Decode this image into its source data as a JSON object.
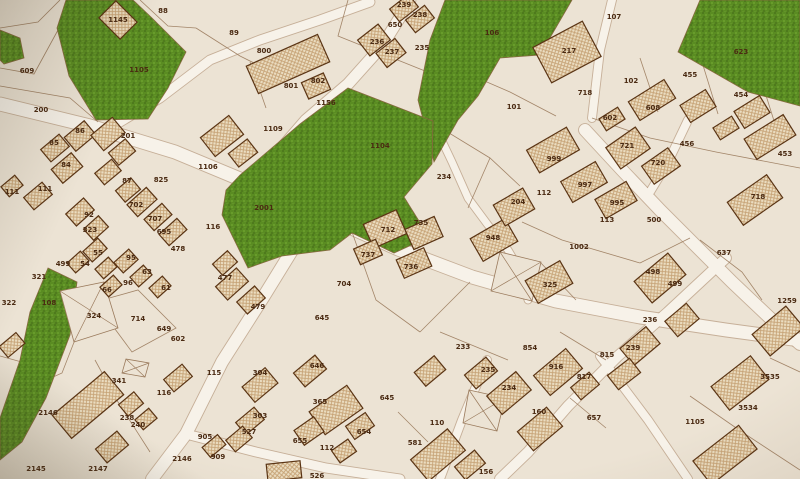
{
  "map": {
    "canvas": {
      "width": 800,
      "height": 479
    },
    "palette": {
      "base": "#ece3d4",
      "road": "#f7f2e9",
      "road_edge": "#b29478",
      "line": "#9a7a5c",
      "green_fill": "#5a8c22",
      "green_edge": "#87693f",
      "building_edge": "#5a3414",
      "label_color": "#4a2a12"
    },
    "green_areas": [
      {
        "name": "park-1105",
        "points": "66,0 133,0 152,18 186,52 168,88 148,119 96,120 69,76 57,28"
      },
      {
        "name": "park-west-sliver",
        "points": "0,30 20,38 24,58 4,64 0,60"
      },
      {
        "name": "park-106",
        "points": "445,0 572,0 540,55 500,58 478,96 458,120 434,162 418,100 430,40"
      },
      {
        "name": "park-623",
        "points": "700,0 800,0 800,106 748,92 678,52"
      },
      {
        "name": "park-1104-2001",
        "points": "348,88 433,121 432,164 404,197 429,237 394,253 352,233 330,250 282,256 248,268 222,215 226,190 240,175 300,124"
      },
      {
        "name": "park-108",
        "points": "48,268 77,282 70,335 46,398 22,442 0,460 0,418 20,360 30,312"
      }
    ],
    "roads": [
      {
        "points": "0,104 90,126 175,152 252,184 318,213 398,249 472,277 556,301 640,317 726,330 800,340",
        "width": 13
      },
      {
        "points": "252,184 280,150 306,120 348,84 382,46 402,14 410,0",
        "width": 11
      },
      {
        "points": "110,128 160,98 210,60 260,40 320,20 370,2",
        "width": 9
      },
      {
        "points": "612,0 600,50 592,118",
        "width": 8
      },
      {
        "points": "585,130 622,170 660,210 696,246 732,282 770,318 800,344",
        "width": 12
      },
      {
        "points": "688,120 668,162 650,192",
        "width": 8
      },
      {
        "points": "312,215 296,244 264,296 222,362 186,434 152,479",
        "width": 12
      },
      {
        "points": "186,434 256,452 326,468 400,479",
        "width": 9
      },
      {
        "points": "726,258 668,312 618,356 568,406 528,452 500,479",
        "width": 10
      },
      {
        "points": "487,360 462,420 440,479",
        "width": 8
      },
      {
        "points": "600,356 648,420 688,479",
        "width": 8
      },
      {
        "points": "433,122 452,162 468,198 488,225 508,250 522,274 528,300",
        "width": 7
      }
    ],
    "parcel_lines": [
      "0,86 70,98 98,122",
      "140,0 168,26 196,28",
      "196,28 240,56 260,66",
      "348,0 338,36 430,73",
      "436,60 510,92 556,116",
      "640,58 658,112",
      "702,62 718,114",
      "758,70 775,124",
      "592,118 650,138 716,152 800,168",
      "436,125 490,158 520,186",
      "490,158 468,208",
      "522,222 562,240 640,263",
      "640,263 690,238",
      "352,232 376,300 420,332",
      "420,332 470,282",
      "95,302 138,290 176,328 132,352 95,302",
      "20,392 62,373 78,332",
      "0,356 36,366",
      "95,360 118,402 150,452",
      "690,396 742,432 800,470",
      "770,358 800,372",
      "700,240 742,272 762,300",
      "440,332 508,360",
      "560,332 606,360",
      "540,262 576,300",
      "398,412 428,442",
      "570,398 606,428",
      "250,62 266,108",
      "0,28 38,22 60,0",
      "0,68 34,74 58,30"
    ],
    "cross_parcels": [
      "60,291 104,282 118,328 74,342",
      "500,252 541,262 532,301 491,291",
      "469,390 505,398 497,431 463,423",
      "126,359 149,363 145,377 122,373"
    ],
    "buildings": [
      [
        118,
        20,
        30,
        24,
        45
      ],
      [
        288,
        64,
        78,
        30,
        -24
      ],
      [
        316,
        86,
        24,
        18,
        -24
      ],
      [
        374,
        40,
        26,
        20,
        -38
      ],
      [
        391,
        53,
        24,
        18,
        -38
      ],
      [
        404,
        8,
        24,
        16,
        -38
      ],
      [
        420,
        19,
        24,
        16,
        -38
      ],
      [
        567,
        52,
        56,
        40,
        -28
      ],
      [
        652,
        100,
        42,
        22,
        -32
      ],
      [
        698,
        106,
        30,
        20,
        -32
      ],
      [
        752,
        112,
        30,
        20,
        -32
      ],
      [
        612,
        119,
        22,
        14,
        -32
      ],
      [
        770,
        137,
        46,
        24,
        -32
      ],
      [
        726,
        128,
        22,
        14,
        -32
      ],
      [
        80,
        136,
        26,
        18,
        -40
      ],
      [
        55,
        148,
        24,
        16,
        -40
      ],
      [
        67,
        168,
        26,
        18,
        -40
      ],
      [
        108,
        134,
        28,
        20,
        -40
      ],
      [
        122,
        152,
        22,
        16,
        -40
      ],
      [
        38,
        196,
        24,
        16,
        -40
      ],
      [
        12,
        186,
        18,
        13,
        -40
      ],
      [
        108,
        172,
        22,
        15,
        -40
      ],
      [
        128,
        190,
        20,
        15,
        -40
      ],
      [
        142,
        202,
        26,
        16,
        -42
      ],
      [
        158,
        217,
        24,
        15,
        -42
      ],
      [
        173,
        232,
        24,
        15,
        -42
      ],
      [
        80,
        212,
        24,
        16,
        -42
      ],
      [
        96,
        228,
        20,
        15,
        -42
      ],
      [
        222,
        136,
        36,
        24,
        -38
      ],
      [
        243,
        153,
        24,
        17,
        -38
      ],
      [
        232,
        284,
        28,
        18,
        -42
      ],
      [
        251,
        300,
        24,
        16,
        -42
      ],
      [
        225,
        263,
        20,
        15,
        -42
      ],
      [
        385,
        229,
        36,
        26,
        -24
      ],
      [
        424,
        233,
        32,
        22,
        -24
      ],
      [
        414,
        263,
        30,
        20,
        -24
      ],
      [
        368,
        252,
        24,
        17,
        -24
      ],
      [
        494,
        240,
        40,
        26,
        -30
      ],
      [
        514,
        207,
        34,
        24,
        -30
      ],
      [
        553,
        150,
        46,
        26,
        -30
      ],
      [
        584,
        182,
        40,
        24,
        -30
      ],
      [
        616,
        200,
        36,
        22,
        -30
      ],
      [
        549,
        282,
        40,
        26,
        -30
      ],
      [
        628,
        148,
        36,
        26,
        -35
      ],
      [
        661,
        166,
        32,
        22,
        -35
      ],
      [
        755,
        200,
        48,
        28,
        -35
      ],
      [
        660,
        278,
        44,
        28,
        -40
      ],
      [
        640,
        346,
        34,
        22,
        -40
      ],
      [
        682,
        320,
        28,
        20,
        -40
      ],
      [
        778,
        331,
        44,
        28,
        -40
      ],
      [
        88,
        405,
        68,
        30,
        -40
      ],
      [
        131,
        404,
        20,
        15,
        -40
      ],
      [
        146,
        419,
        18,
        13,
        -40
      ],
      [
        112,
        447,
        28,
        18,
        -40
      ],
      [
        178,
        378,
        24,
        16,
        -40
      ],
      [
        260,
        385,
        30,
        20,
        -40
      ],
      [
        310,
        371,
        28,
        18,
        -40
      ],
      [
        250,
        421,
        24,
        16,
        -40
      ],
      [
        239,
        439,
        22,
        15,
        -40
      ],
      [
        336,
        410,
        46,
        28,
        -35
      ],
      [
        309,
        431,
        24,
        18,
        -35
      ],
      [
        360,
        426,
        24,
        16,
        -35
      ],
      [
        344,
        451,
        20,
        15,
        -35
      ],
      [
        284,
        471,
        34,
        17,
        -6
      ],
      [
        214,
        446,
        20,
        13,
        -40
      ],
      [
        430,
        371,
        26,
        18,
        -40
      ],
      [
        509,
        393,
        38,
        24,
        -40
      ],
      [
        481,
        373,
        28,
        18,
        -40
      ],
      [
        540,
        429,
        38,
        25,
        -40
      ],
      [
        558,
        372,
        42,
        26,
        -40
      ],
      [
        585,
        386,
        24,
        16,
        -40
      ],
      [
        438,
        455,
        48,
        28,
        -40
      ],
      [
        470,
        465,
        26,
        17,
        -40
      ],
      [
        740,
        383,
        50,
        30,
        -38
      ],
      [
        725,
        455,
        58,
        30,
        -38
      ],
      [
        624,
        374,
        28,
        18,
        -38
      ],
      [
        95,
        250,
        20,
        14,
        -42
      ],
      [
        78,
        262,
        18,
        13,
        -42
      ],
      [
        106,
        268,
        18,
        13,
        -42
      ],
      [
        126,
        261,
        20,
        14,
        -42
      ],
      [
        141,
        276,
        18,
        13,
        -42
      ],
      [
        111,
        286,
        18,
        13,
        -42
      ],
      [
        160,
        287,
        18,
        13,
        -42
      ],
      [
        12,
        345,
        22,
        14,
        -40
      ]
    ],
    "labels": [
      {
        "n": "88",
        "x": 163,
        "y": 11
      },
      {
        "n": "1145",
        "x": 118,
        "y": 20
      },
      {
        "n": "1105",
        "x": 139,
        "y": 70
      },
      {
        "n": "609",
        "x": 27,
        "y": 71
      },
      {
        "n": "200",
        "x": 41,
        "y": 110
      },
      {
        "n": "89",
        "x": 234,
        "y": 33
      },
      {
        "n": "800",
        "x": 264,
        "y": 51
      },
      {
        "n": "801",
        "x": 291,
        "y": 86
      },
      {
        "n": "802",
        "x": 318,
        "y": 81
      },
      {
        "n": "1156",
        "x": 326,
        "y": 103
      },
      {
        "n": "650",
        "x": 395,
        "y": 25
      },
      {
        "n": "239",
        "x": 404,
        "y": 5
      },
      {
        "n": "238",
        "x": 420,
        "y": 15
      },
      {
        "n": "236",
        "x": 377,
        "y": 42
      },
      {
        "n": "237",
        "x": 392,
        "y": 52
      },
      {
        "n": "235",
        "x": 422,
        "y": 48
      },
      {
        "n": "107",
        "x": 614,
        "y": 17
      },
      {
        "n": "106",
        "x": 492,
        "y": 33
      },
      {
        "n": "623",
        "x": 741,
        "y": 52
      },
      {
        "n": "102",
        "x": 631,
        "y": 81
      },
      {
        "n": "455",
        "x": 690,
        "y": 75
      },
      {
        "n": "454",
        "x": 741,
        "y": 95
      },
      {
        "n": "608",
        "x": 653,
        "y": 108
      },
      {
        "n": "602",
        "x": 610,
        "y": 118
      },
      {
        "n": "718",
        "x": 585,
        "y": 93
      },
      {
        "n": "101",
        "x": 514,
        "y": 107
      },
      {
        "n": "217",
        "x": 569,
        "y": 51
      },
      {
        "n": "1109",
        "x": 273,
        "y": 129
      },
      {
        "n": "1106",
        "x": 208,
        "y": 167
      },
      {
        "n": "1104",
        "x": 380,
        "y": 146
      },
      {
        "n": "86",
        "x": 80,
        "y": 131
      },
      {
        "n": "201",
        "x": 128,
        "y": 136
      },
      {
        "n": "85",
        "x": 54,
        "y": 143
      },
      {
        "n": "84",
        "x": 66,
        "y": 165
      },
      {
        "n": "87",
        "x": 127,
        "y": 181
      },
      {
        "n": "825",
        "x": 161,
        "y": 180
      },
      {
        "n": "111",
        "x": 12,
        "y": 192
      },
      {
        "n": "111",
        "x": 45,
        "y": 189
      },
      {
        "n": "702",
        "x": 136,
        "y": 205
      },
      {
        "n": "707",
        "x": 155,
        "y": 219
      },
      {
        "n": "92",
        "x": 89,
        "y": 215
      },
      {
        "n": "323",
        "x": 90,
        "y": 230
      },
      {
        "n": "695",
        "x": 164,
        "y": 232
      },
      {
        "n": "2001",
        "x": 264,
        "y": 208
      },
      {
        "n": "116",
        "x": 213,
        "y": 227
      },
      {
        "n": "712",
        "x": 388,
        "y": 230
      },
      {
        "n": "234",
        "x": 444,
        "y": 177
      },
      {
        "n": "999",
        "x": 554,
        "y": 159
      },
      {
        "n": "112",
        "x": 544,
        "y": 193
      },
      {
        "n": "997",
        "x": 585,
        "y": 185
      },
      {
        "n": "995",
        "x": 617,
        "y": 203
      },
      {
        "n": "204",
        "x": 518,
        "y": 202
      },
      {
        "n": "113",
        "x": 607,
        "y": 220
      },
      {
        "n": "1002",
        "x": 579,
        "y": 247
      },
      {
        "n": "948",
        "x": 493,
        "y": 238
      },
      {
        "n": "721",
        "x": 627,
        "y": 146
      },
      {
        "n": "456",
        "x": 687,
        "y": 144
      },
      {
        "n": "453",
        "x": 785,
        "y": 154
      },
      {
        "n": "720",
        "x": 658,
        "y": 163
      },
      {
        "n": "718",
        "x": 758,
        "y": 197
      },
      {
        "n": "500",
        "x": 654,
        "y": 220
      },
      {
        "n": "478",
        "x": 178,
        "y": 249
      },
      {
        "n": "55",
        "x": 98,
        "y": 253
      },
      {
        "n": "54",
        "x": 85,
        "y": 264
      },
      {
        "n": "95",
        "x": 131,
        "y": 258
      },
      {
        "n": "63",
        "x": 147,
        "y": 272
      },
      {
        "n": "96",
        "x": 128,
        "y": 283
      },
      {
        "n": "66",
        "x": 107,
        "y": 290
      },
      {
        "n": "61",
        "x": 166,
        "y": 288
      },
      {
        "n": "321",
        "x": 39,
        "y": 277
      },
      {
        "n": "499",
        "x": 63,
        "y": 264
      },
      {
        "n": "322",
        "x": 9,
        "y": 303
      },
      {
        "n": "108",
        "x": 49,
        "y": 303
      },
      {
        "n": "324",
        "x": 94,
        "y": 316
      },
      {
        "n": "714",
        "x": 138,
        "y": 319
      },
      {
        "n": "649",
        "x": 164,
        "y": 329
      },
      {
        "n": "602",
        "x": 178,
        "y": 339
      },
      {
        "n": "477",
        "x": 225,
        "y": 278
      },
      {
        "n": "479",
        "x": 258,
        "y": 307
      },
      {
        "n": "704",
        "x": 344,
        "y": 284
      },
      {
        "n": "737",
        "x": 368,
        "y": 255
      },
      {
        "n": "645",
        "x": 322,
        "y": 318
      },
      {
        "n": "735",
        "x": 421,
        "y": 223
      },
      {
        "n": "736",
        "x": 411,
        "y": 267
      },
      {
        "n": "325",
        "x": 550,
        "y": 285
      },
      {
        "n": "233",
        "x": 463,
        "y": 347
      },
      {
        "n": "854",
        "x": 530,
        "y": 348
      },
      {
        "n": "637",
        "x": 724,
        "y": 253
      },
      {
        "n": "498",
        "x": 653,
        "y": 272
      },
      {
        "n": "499",
        "x": 675,
        "y": 284
      },
      {
        "n": "236",
        "x": 650,
        "y": 320
      },
      {
        "n": "1259",
        "x": 787,
        "y": 301
      },
      {
        "n": "239",
        "x": 633,
        "y": 348
      },
      {
        "n": "815",
        "x": 607,
        "y": 355
      },
      {
        "n": "341",
        "x": 119,
        "y": 381
      },
      {
        "n": "116",
        "x": 164,
        "y": 393
      },
      {
        "n": "2146",
        "x": 48,
        "y": 413
      },
      {
        "n": "238",
        "x": 127,
        "y": 418
      },
      {
        "n": "240",
        "x": 138,
        "y": 425
      },
      {
        "n": "2146",
        "x": 182,
        "y": 459
      },
      {
        "n": "2147",
        "x": 98,
        "y": 469
      },
      {
        "n": "2145",
        "x": 36,
        "y": 469
      },
      {
        "n": "115",
        "x": 214,
        "y": 373
      },
      {
        "n": "304",
        "x": 260,
        "y": 373
      },
      {
        "n": "646",
        "x": 317,
        "y": 366
      },
      {
        "n": "303",
        "x": 260,
        "y": 416
      },
      {
        "n": "527",
        "x": 249,
        "y": 432
      },
      {
        "n": "905",
        "x": 205,
        "y": 437
      },
      {
        "n": "909",
        "x": 218,
        "y": 457
      },
      {
        "n": "365",
        "x": 320,
        "y": 402
      },
      {
        "n": "655",
        "x": 300,
        "y": 441
      },
      {
        "n": "654",
        "x": 364,
        "y": 432
      },
      {
        "n": "112",
        "x": 327,
        "y": 448
      },
      {
        "n": "526",
        "x": 317,
        "y": 476
      },
      {
        "n": "645",
        "x": 387,
        "y": 398
      },
      {
        "n": "235",
        "x": 488,
        "y": 370
      },
      {
        "n": "234",
        "x": 509,
        "y": 388
      },
      {
        "n": "916",
        "x": 556,
        "y": 367
      },
      {
        "n": "817",
        "x": 584,
        "y": 377
      },
      {
        "n": "160",
        "x": 539,
        "y": 412
      },
      {
        "n": "657",
        "x": 594,
        "y": 418
      },
      {
        "n": "110",
        "x": 437,
        "y": 423
      },
      {
        "n": "581",
        "x": 415,
        "y": 443
      },
      {
        "n": "156",
        "x": 486,
        "y": 472
      },
      {
        "n": "3535",
        "x": 770,
        "y": 377
      },
      {
        "n": "3534",
        "x": 748,
        "y": 408
      },
      {
        "n": "1105",
        "x": 695,
        "y": 422
      }
    ]
  }
}
